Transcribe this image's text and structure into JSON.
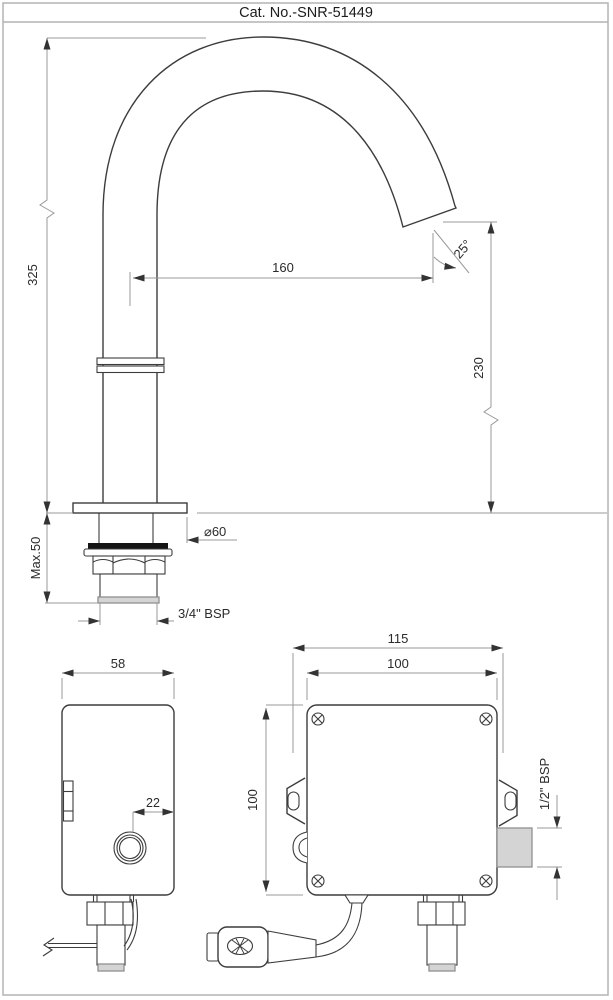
{
  "title": "Cat. No.-SNR-51449",
  "colors": {
    "drawing_line": "#3c3c3c",
    "dimension_line": "#999999",
    "arrow": "#333333",
    "frame": "#b4b4b4",
    "gasket": "#151515",
    "pipe_fill": "#d4d4d4",
    "background": "#ffffff"
  },
  "faucet_view": {
    "height": "325",
    "reach": "160",
    "spout_angle": "25°",
    "outlet_height": "230",
    "deck_max": "Max.50",
    "flange_diameter": "⌀60",
    "inlet_thread": "3/4\" BSP"
  },
  "control_box_side": {
    "depth": "58",
    "sensor_offset": "22"
  },
  "control_box_front": {
    "overall_width": "115",
    "width": "100",
    "height": "100",
    "outlet_thread": "1/2\" BSP"
  }
}
